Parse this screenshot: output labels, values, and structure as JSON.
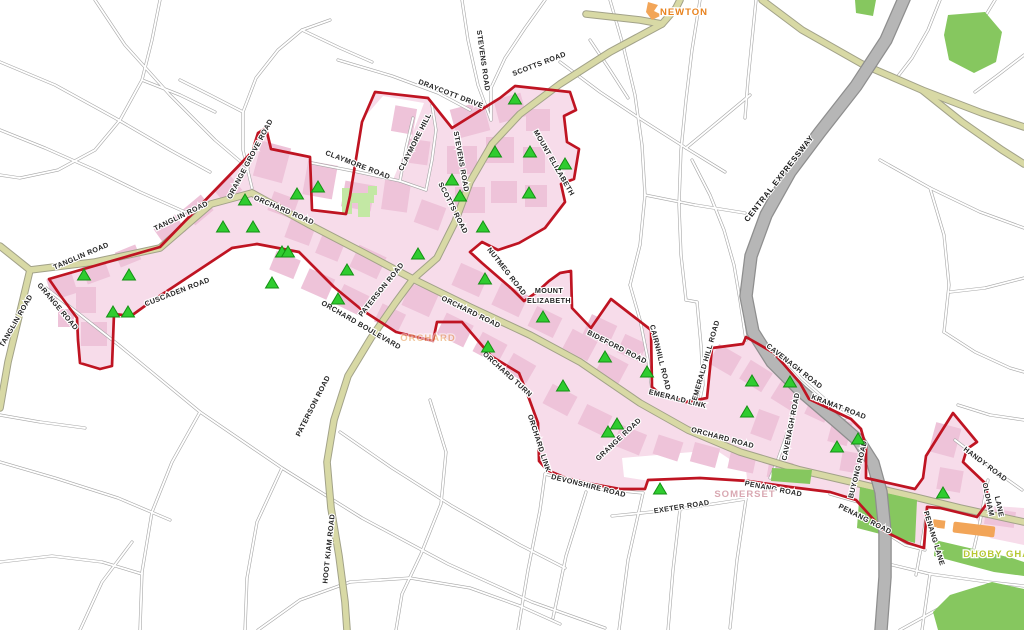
{
  "map": {
    "colors": {
      "boundary": "#bf1422",
      "road_major": "#d8d9a5",
      "expressway": "#b6b6b6",
      "district_area": "#f7dcea",
      "building": "#eec3d9",
      "park": "#86c75f",
      "park_light": "#c3e8a4",
      "orange_area": "#f2a558",
      "marker": "#2fcc2f",
      "marker_edge": "#149114"
    },
    "road_labels": [
      {
        "text": "TANGLIN ROAD",
        "x": 82,
        "y": 258,
        "r": -23
      },
      {
        "text": "TANGLIN ROAD",
        "x": 182,
        "y": 218,
        "r": -26
      },
      {
        "text": "TANGLIN ROAD",
        "x": 18,
        "y": 322,
        "r": -60
      },
      {
        "text": "GRANGE ROAD",
        "x": 56,
        "y": 308,
        "r": 50
      },
      {
        "text": "CUSCADEN ROAD",
        "x": 178,
        "y": 294,
        "r": -21
      },
      {
        "text": "ORANGE GROVE ROAD",
        "x": 252,
        "y": 160,
        "r": -62
      },
      {
        "text": "ORCHARD ROAD",
        "x": 283,
        "y": 212,
        "r": 23
      },
      {
        "text": "CLAYMORE ROAD",
        "x": 357,
        "y": 167,
        "r": 21
      },
      {
        "text": "CLAYMORE HILL",
        "x": 417,
        "y": 143,
        "r": -63
      },
      {
        "text": "DRAYCOTT DRIVE",
        "x": 450,
        "y": 96,
        "r": 21
      },
      {
        "text": "STEVENS ROAD",
        "x": 481,
        "y": 61,
        "r": 82
      },
      {
        "text": "SCOTTS ROAD",
        "x": 540,
        "y": 66,
        "r": -21
      },
      {
        "text": "STEVENS ROAD",
        "x": 459,
        "y": 162,
        "r": 80
      },
      {
        "text": "SCOTTS ROAD",
        "x": 451,
        "y": 209,
        "r": 63
      },
      {
        "text": "MOUNT ELIZABETH",
        "x": 552,
        "y": 164,
        "r": 60
      },
      {
        "text": "MOUNT",
        "x": 549,
        "y": 293,
        "r": 0
      },
      {
        "text": "ELIZABETH",
        "x": 549,
        "y": 303,
        "r": 0
      },
      {
        "text": "NUTMEG ROAD",
        "x": 505,
        "y": 273,
        "r": 52
      },
      {
        "text": "PATERSON ROAD",
        "x": 383,
        "y": 291,
        "r": -51
      },
      {
        "text": "PATERSON ROAD",
        "x": 315,
        "y": 407,
        "r": -63
      },
      {
        "text": "HOOT KIAM ROAD",
        "x": 331,
        "y": 549,
        "r": -84
      },
      {
        "text": "ORCHARD BOULEVARD",
        "x": 360,
        "y": 327,
        "r": 30
      },
      {
        "text": "ORCHARD ROAD",
        "x": 470,
        "y": 314,
        "r": 26
      },
      {
        "text": "ORCHARD TURN",
        "x": 506,
        "y": 376,
        "r": 42
      },
      {
        "text": "ORCHARD LINK",
        "x": 537,
        "y": 444,
        "r": 72
      },
      {
        "text": "GRANGE ROAD",
        "x": 620,
        "y": 441,
        "r": -43
      },
      {
        "text": "EMERALD LINK",
        "x": 677,
        "y": 401,
        "r": 14
      },
      {
        "text": "ORCHARD ROAD",
        "x": 722,
        "y": 440,
        "r": 15
      },
      {
        "text": "BIDEFORD ROAD",
        "x": 616,
        "y": 349,
        "r": 27
      },
      {
        "text": "CAIRNHILL ROAD",
        "x": 658,
        "y": 358,
        "r": 76
      },
      {
        "text": "EMERALD HILL ROAD",
        "x": 708,
        "y": 361,
        "r": -74
      },
      {
        "text": "CAVENAGH ROAD",
        "x": 793,
        "y": 368,
        "r": 38
      },
      {
        "text": "CAVENAGH ROAD",
        "x": 793,
        "y": 427,
        "r": -79
      },
      {
        "text": "KRAMAT ROAD",
        "x": 838,
        "y": 409,
        "r": 21
      },
      {
        "text": "BUYONG ROAD",
        "x": 860,
        "y": 470,
        "r": -76
      },
      {
        "text": "PENANG ROAD",
        "x": 773,
        "y": 491,
        "r": 11
      },
      {
        "text": "PENANG ROAD",
        "x": 864,
        "y": 521,
        "r": 27
      },
      {
        "text": "DEVONSHIRE ROAD",
        "x": 588,
        "y": 488,
        "r": 14
      },
      {
        "text": "EXETER ROAD",
        "x": 682,
        "y": 509,
        "r": -9
      },
      {
        "text": "HANDY ROAD",
        "x": 984,
        "y": 466,
        "r": 37
      },
      {
        "text": "OLDHAM",
        "x": 986,
        "y": 500,
        "r": 78
      },
      {
        "text": "LANE",
        "x": 997,
        "y": 507,
        "r": 78
      },
      {
        "text": "PENANG LANE",
        "x": 932,
        "y": 539,
        "r": 73
      },
      {
        "text": "CENTRAL EXPRESSWAY",
        "x": 781,
        "y": 180,
        "r": -52,
        "big": true
      }
    ],
    "station_labels": [
      {
        "text": "NEWTON",
        "x": 684,
        "y": 15,
        "color": "#e8821e",
        "opacity": 1
      },
      {
        "text": "ORCHARD",
        "x": 428,
        "y": 341,
        "color": "#e89a50",
        "opacity": 0.55
      },
      {
        "text": "SOMERSET",
        "x": 745,
        "y": 497,
        "color": "#d9a8b2",
        "opacity": 1
      },
      {
        "text": "DHOBY GHAUT",
        "x": 1004,
        "y": 557,
        "color": "#b6c832",
        "opacity": 1
      }
    ],
    "markers": [
      [
        84,
        276
      ],
      [
        129,
        276
      ],
      [
        113,
        313
      ],
      [
        128,
        313
      ],
      [
        223,
        228
      ],
      [
        245,
        201
      ],
      [
        253,
        228
      ],
      [
        272,
        284
      ],
      [
        282,
        253
      ],
      [
        288,
        253
      ],
      [
        297,
        195
      ],
      [
        318,
        188
      ],
      [
        347,
        271
      ],
      [
        338,
        300
      ],
      [
        418,
        255
      ],
      [
        452,
        181
      ],
      [
        460,
        197
      ],
      [
        483,
        228
      ],
      [
        495,
        153
      ],
      [
        515,
        100
      ],
      [
        530,
        153
      ],
      [
        565,
        165
      ],
      [
        529,
        194
      ],
      [
        485,
        280
      ],
      [
        543,
        318
      ],
      [
        488,
        348
      ],
      [
        563,
        387
      ],
      [
        605,
        358
      ],
      [
        647,
        373
      ],
      [
        608,
        433
      ],
      [
        617,
        425
      ],
      [
        660,
        490
      ],
      [
        752,
        382
      ],
      [
        790,
        383
      ],
      [
        747,
        413
      ],
      [
        858,
        440
      ],
      [
        837,
        448
      ],
      [
        943,
        494
      ]
    ]
  }
}
